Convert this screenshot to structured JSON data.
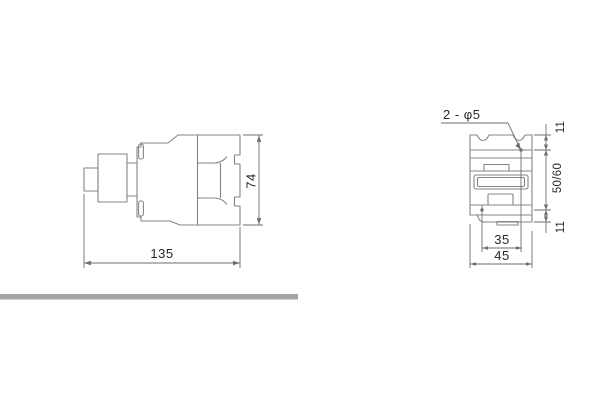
{
  "drawing": {
    "side_view": {
      "dim_length": "135",
      "dim_height": "74"
    },
    "front_view": {
      "holes_label": "2 - φ5",
      "dim_hole_top_offset": "11",
      "dim_hole_vertical_spacing": "50/60",
      "dim_hole_bottom_offset": "11",
      "dim_hole_horizontal_spacing": "35",
      "dim_width": "45"
    }
  },
  "colors": {
    "background": "#ffffff",
    "body_outline": "#84848c",
    "dimension_line": "#6e6e75",
    "text": "#28282a",
    "divider_bar": "#a6a6a9"
  }
}
